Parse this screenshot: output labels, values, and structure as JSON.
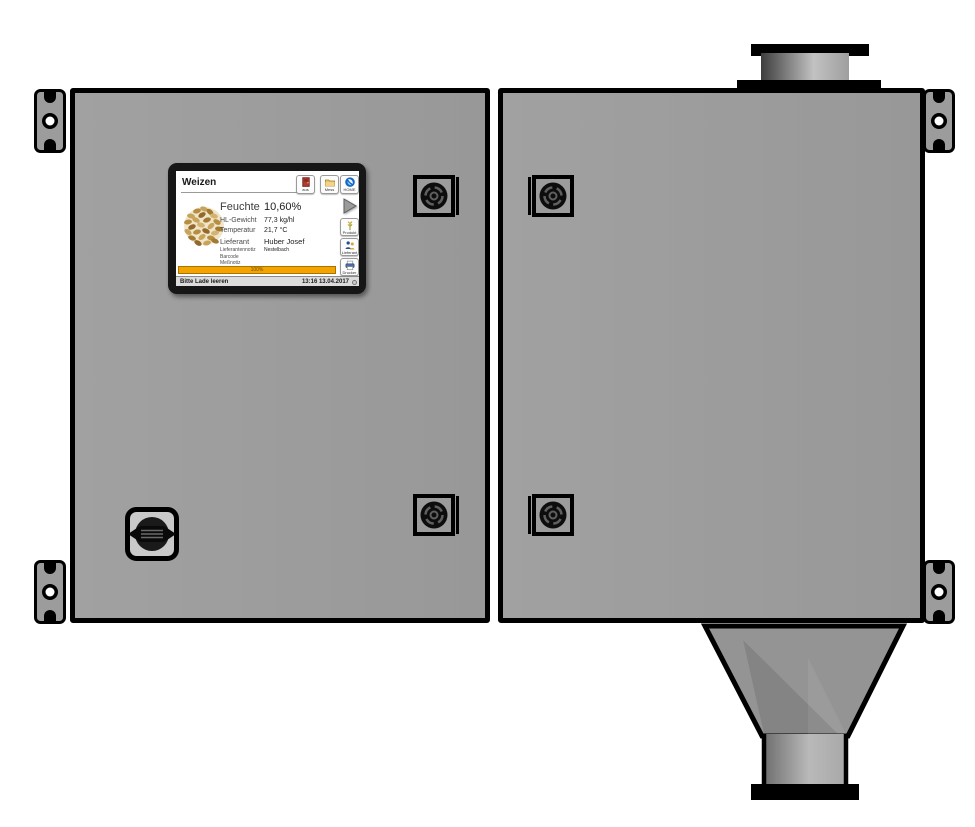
{
  "hmi": {
    "title": "Weizen",
    "toolbar": [
      {
        "label": "aus",
        "icon": "exit-door-icon"
      },
      {
        "label": "Mess",
        "icon": "folder-icon"
      },
      {
        "label": "HOME",
        "icon": "home-logo-icon"
      }
    ],
    "side_buttons": [
      {
        "label": "Produkt",
        "icon": "wheat-icon"
      },
      {
        "label": "Lieferant",
        "icon": "supplier-people-icon"
      },
      {
        "label": "Drucker",
        "icon": "printer-icon"
      }
    ],
    "readings": [
      {
        "label": "Feuchte",
        "value": "10,60%"
      },
      {
        "label": "HL-Gewicht",
        "value": "77,3 kg/hl"
      },
      {
        "label": "Temperatur",
        "value": "21,7 °C"
      },
      {
        "label": "Lieferant",
        "value": "Huber Josef"
      },
      {
        "label": "Lieferantennotiz",
        "value": "Nestelbach"
      },
      {
        "label": "Barcode",
        "value": ""
      },
      {
        "label": "Meßnotiz",
        "value": ""
      }
    ],
    "progress": {
      "label": "100%",
      "color": "#f4a400"
    },
    "statusbar": {
      "message": "Bitte Lade leeren",
      "datetime": "13:16 13.04.2017"
    }
  },
  "cabinet": {
    "panel_color": "#9c9c9c",
    "outline_color": "#000000"
  }
}
